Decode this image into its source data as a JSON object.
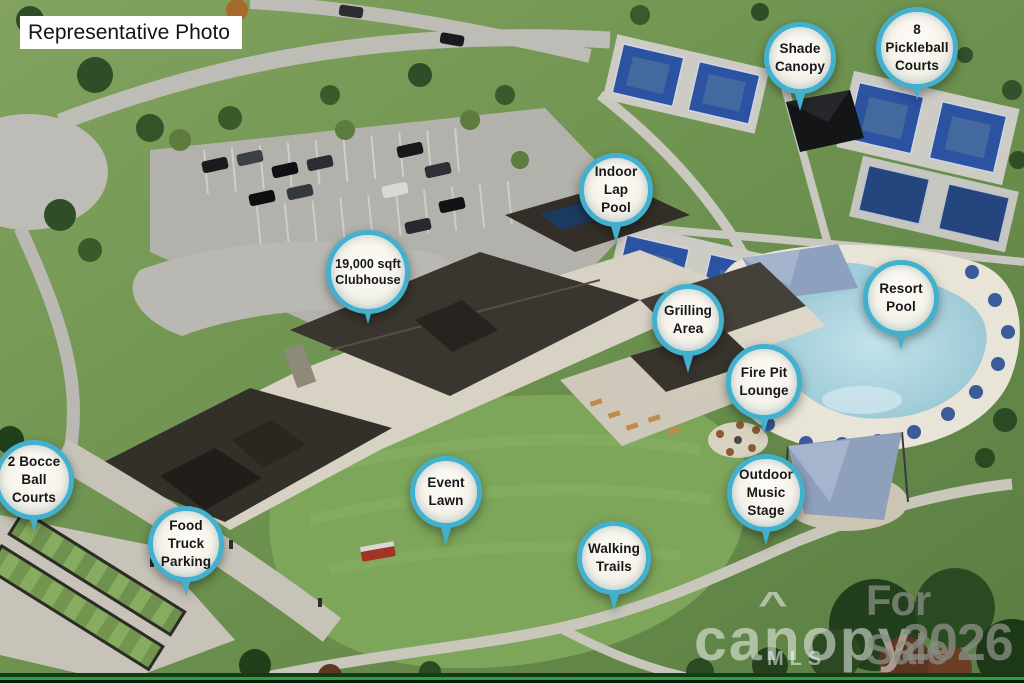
{
  "overlay": {
    "photo_tag": "Representative Photo"
  },
  "pins": [
    {
      "id": "shade-canopy",
      "label": "Shade\nCanopy"
    },
    {
      "id": "pickleball-courts",
      "label": "8\nPickleball\nCourts"
    },
    {
      "id": "indoor-lap-pool",
      "label": "Indoor\nLap\nPool"
    },
    {
      "id": "clubhouse",
      "label": "19,000 sqft\nClubhouse"
    },
    {
      "id": "resort-pool",
      "label": "Resort\nPool"
    },
    {
      "id": "grilling-area",
      "label": "Grilling\nArea"
    },
    {
      "id": "fire-pit-lounge",
      "label": "Fire Pit\nLounge"
    },
    {
      "id": "event-lawn",
      "label": "Event\nLawn"
    },
    {
      "id": "outdoor-music-stage",
      "label": "Outdoor\nMusic\nStage"
    },
    {
      "id": "walking-trails",
      "label": "Walking\nTrails"
    },
    {
      "id": "food-truck-parking",
      "label": "Food\nTruck\nParking"
    },
    {
      "id": "bocce-courts",
      "label": "2 Bocce\nBall\nCourts"
    }
  ],
  "watermark": {
    "line1": "For Sale",
    "line2": "2026",
    "brand": "canopy",
    "brand_caret": "^",
    "brand_sub": "MLS"
  },
  "colors": {
    "pin_ring": "#43b0cd",
    "pin_fill": "#f6f3e9",
    "pin_text": "#17171a",
    "court_blue": "#2c52a2",
    "pool_water": "#a6d0dc",
    "lawn_green": "#7da65a",
    "watermark_gray": "#878c82"
  }
}
